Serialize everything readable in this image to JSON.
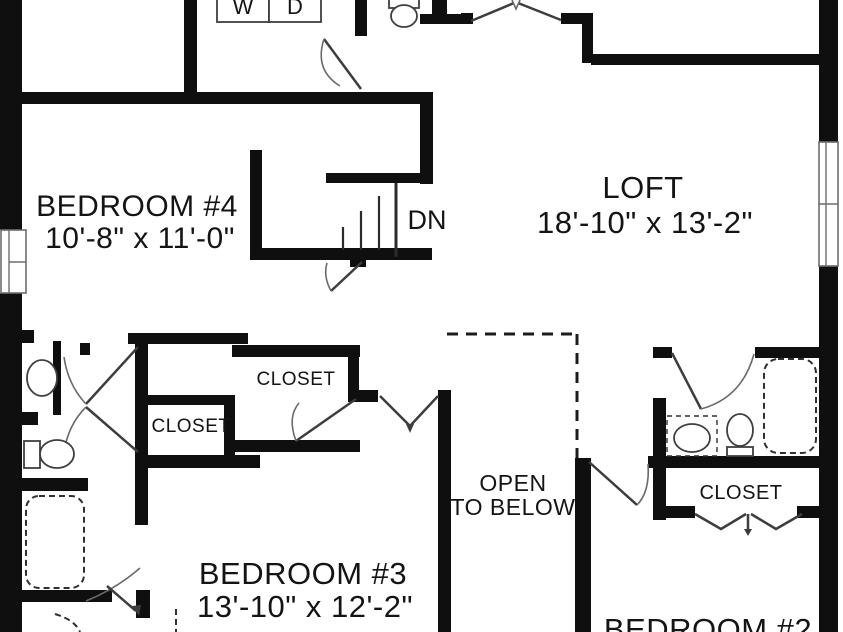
{
  "plan": {
    "title": "Second floor plan",
    "colors": {
      "wall": "#0f0f0f",
      "background": "#ffffff",
      "line": "#3d3d3d"
    },
    "rooms": {
      "bedroom4": {
        "name": "BEDROOM #4",
        "dims": "10'-8\" x 11'-0\""
      },
      "loft": {
        "name": "LOFT",
        "dims": "18'-10\" x 13'-2\""
      },
      "bedroom3": {
        "name": "BEDROOM #3",
        "dims": "13'-10\" x 12'-2\""
      },
      "bedroom2": {
        "name": "BEDROOM #2"
      },
      "open_to_below": {
        "line1": "OPEN",
        "line2": "TO BELOW"
      }
    },
    "closets": {
      "hall_upper": "CLOSET",
      "hall_lower": "CLOSET",
      "bedroom2_closet": "CLOSET"
    },
    "labels": {
      "stairs_down": "DN",
      "washer": "W",
      "dryer": "D"
    },
    "fixtures": [
      "washer-box",
      "dryer-box",
      "toilet",
      "sink",
      "bathtub",
      "double-door",
      "bifold-door",
      "window",
      "stairs-down"
    ]
  }
}
